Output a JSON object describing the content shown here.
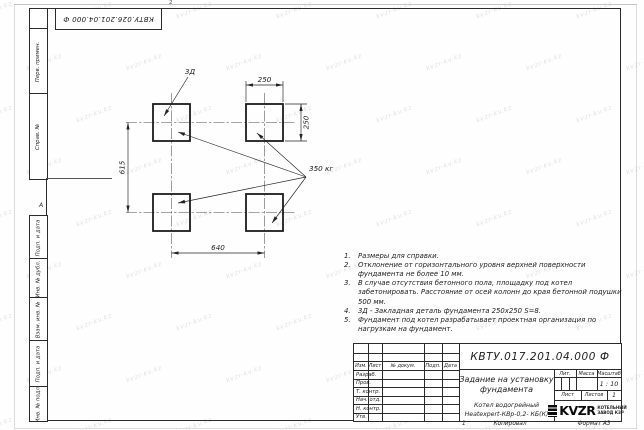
{
  "corner_designation": "КВТУ.026.201.04.000 Ф",
  "zone_marks": {
    "top_mark": "2",
    "side_mark": "А"
  },
  "margin_stamps": [
    "Перв. примен.",
    "Справ. №",
    "Подп. и дата",
    "Инв. № дубл.",
    "Взам. инв. №",
    "Подп. и дата",
    "Инв. № подл."
  ],
  "drawing": {
    "detail_label": "3Д",
    "load_label": "350 кг",
    "dim_pad_width": "250",
    "dim_pad_height": "250",
    "dim_row_spacing": "615",
    "dim_col_spacing": "640"
  },
  "notes": [
    {
      "num": "1.",
      "text": "Размеры для справки."
    },
    {
      "num": "2.",
      "text": "Отклонение от горизонтального уровня верхней поверхности фундамента не более 10 мм."
    },
    {
      "num": "3.",
      "text": "В случае отсутствия бетонного пола, площадку под котел забетонировать. Расстояние от осей колонн до края бетонной подушки 500 мм."
    },
    {
      "num": "4.",
      "text": "3Д - Закладная деталь фундамента 250х250 S=8."
    },
    {
      "num": "5.",
      "text": "Фундамент под котел разрабатывает проектная организация по нагрузкам на фундамент."
    }
  ],
  "title_block": {
    "designation": "КВТУ.017.201.04.000 Ф",
    "doc_title_line1": "Задание на установку",
    "doc_title_line2": "фундамента",
    "product_line1": "Котел водогрейный",
    "product_line2": "Heatexpert-КВр-0,2- КБ(К)",
    "columns": {
      "izm": "Изм.",
      "list": "Лист",
      "doc": "№ докум.",
      "podp": "Подп.",
      "data": "Дата"
    },
    "roles": [
      "Разраб.",
      "Пров.",
      "Т. контр.",
      "Нач. отд.",
      "Н. контр.",
      "Утв."
    ],
    "lit_label": "Лит.",
    "mass_label": "Масса",
    "scale_label": "Масштаб",
    "scale_value": "1 : 10",
    "sheet_label": "Лист",
    "sheets_label": "Листов",
    "sheets_value": "1",
    "logo_text": "KVZR",
    "company_line1": "КОТЕЛЬНЫЙ",
    "company_line2": "ЗАВОД КЗР"
  },
  "footer": {
    "sheet_num": "1",
    "copied": "Копировал",
    "format": "Формат А3"
  },
  "watermark": {
    "text": "kvzr-kv.kz"
  }
}
